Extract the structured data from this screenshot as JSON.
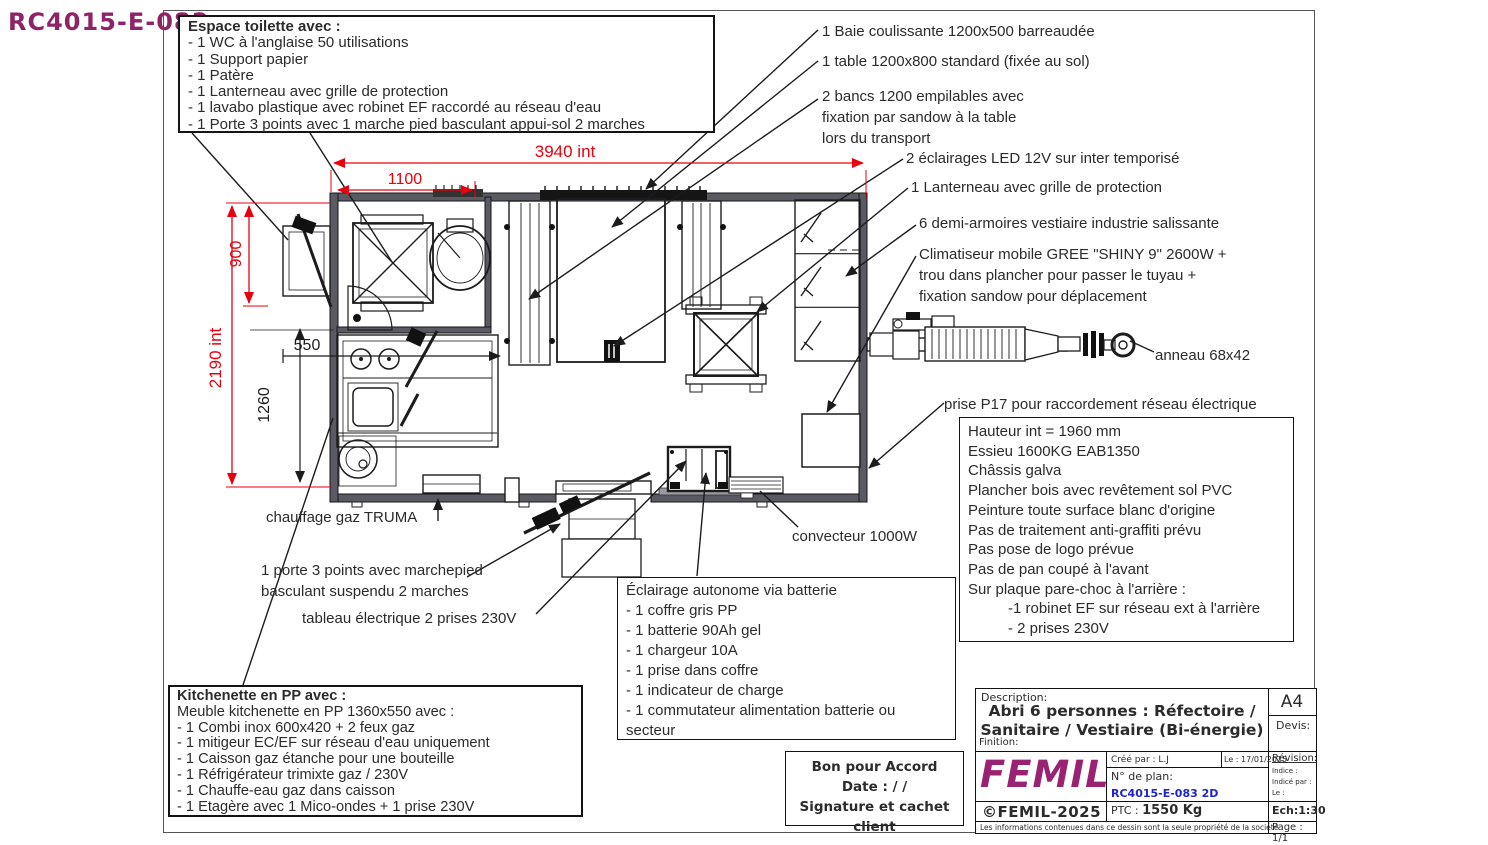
{
  "plan_ref": "RC4015-E-083",
  "colors": {
    "dimension_red": "#e8000d",
    "brand_magenta": "#9a2272",
    "plan_blue": "#1f25c8"
  },
  "toilet_box": {
    "title": "Espace toilette avec :",
    "items": [
      "- 1 WC à l'anglaise 50 utilisations",
      "- 1 Support papier",
      "- 1 Patère",
      "- 1 Lanterneau avec grille de protection",
      "- 1 lavabo plastique avec robinet EF raccordé au réseau d'eau",
      "- 1 Porte 3 points avec 1 marche pied basculant appui-sol 2 marches"
    ]
  },
  "callouts": {
    "baie": "1 Baie coulissante 1200x500 barreaudée",
    "table": "1 table 1200x800 standard (fixée au sol)",
    "bancs": "2 bancs 1200 empilables  avec\nfixation par sandow à la table\nlors du transport",
    "eclairages": "2 éclairages LED 12V sur inter temporisé",
    "lanterneau": "1 Lanterneau avec grille de protection",
    "armoires": "6 demi-armoires vestiaire industrie salissante",
    "climatiseur": "Climatiseur mobile GREE \"SHINY 9\" 2600W  +\ntrou dans plancher pour passer le tuyau +\nfixation sandow pour déplacement",
    "anneau": "anneau 68x42",
    "prise": "prise P17 pour raccordement réseau électrique",
    "chauffage": "chauffage gaz TRUMA",
    "porte": "1 porte 3 points avec marchepied\nbasculant suspendu 2 marches",
    "tableau": "tableau électrique 2 prises 230V",
    "convecteur": "convecteur 1000W"
  },
  "spec_box": {
    "lines": [
      "Hauteur int = 1960 mm",
      "Essieu 1600KG EAB1350",
      "Châssis galva",
      "Plancher bois avec revêtement sol PVC",
      "Peinture toute surface blanc d'origine",
      "Pas de traitement anti-graffiti prévu",
      "Pas pose de logo prévue",
      "Pas de pan coupé à l'avant",
      "Sur plaque pare-choc à l'arrière :",
      "-1 robinet EF sur réseau ext à l'arrière",
      "- 2 prises 230V"
    ]
  },
  "battery_box": {
    "title": "Éclairage autonome via batterie",
    "items": [
      "- 1 coffre gris PP",
      "- 1 batterie 90Ah gel",
      "- 1 chargeur 10A",
      "- 1 prise dans coffre",
      "- 1 indicateur de charge",
      "- 1 commutateur alimentation batterie ou secteur"
    ]
  },
  "kitchenette_box": {
    "title": "Kitchenette en PP avec :",
    "subtitle": "Meuble kitchenette en  PP 1360x550 avec :",
    "items": [
      "- 1 Combi inox 600x420 + 2 feux gaz",
      "- 1 mitigeur EC/EF sur réseau d'eau uniquement",
      "- 1 Caisson gaz étanche pour une bouteille",
      "- 1 Réfrigérateur trimixte gaz / 230V",
      "- 1 Chauffe-eau gaz dans caisson",
      "- 1 Etagère avec 1 Mico-ondes + 1 prise 230V"
    ]
  },
  "approval_box": {
    "title": "Bon pour Accord",
    "date_line": "Date :   /   /",
    "signature_line": "Signature et cachet client"
  },
  "dimensions": {
    "overall_width": "3940 int",
    "toilet_width": "1100",
    "toilet_depth": "900",
    "overall_depth": "2190 int",
    "kitchen_depth": "550",
    "kitchen_length": "1260"
  },
  "title_block": {
    "description_label": "Description:",
    "description": "Abri 6 personnes : Réfectoire  /\nSanitaire / Vestiaire (Bi-énergie)",
    "format": "A4",
    "devis_label": "Devis:",
    "finition_label": "Finition:",
    "logo": "FEMIL",
    "created_by": "Créé par : L.J",
    "date": "Le : 17/01/2025",
    "revision_label": "Révision:",
    "indice_label": "Indice :",
    "indice_par_label": "Indicé par :",
    "le_label": "Le :",
    "plan_number_label": "N° de plan:",
    "plan_number": "RC4015-E-083 2D",
    "copyright": "©FEMIL-2025",
    "ptc_label": "PTC :",
    "ptc_value": "1550 Kg",
    "scale": "Ech:1:30",
    "footer": "Les informations contenues dans ce dessin sont la seule propriété de la société",
    "page": "Page : 1/1"
  }
}
